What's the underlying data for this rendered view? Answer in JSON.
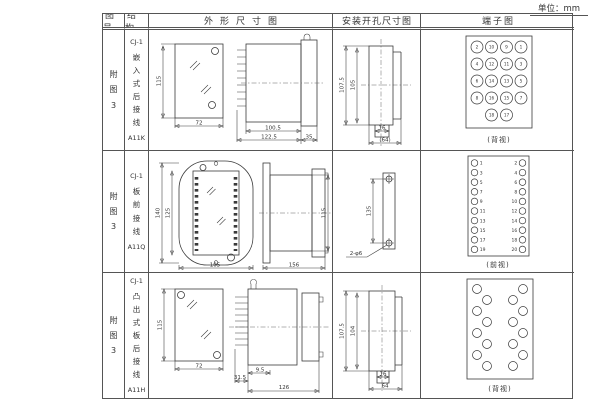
{
  "page": {
    "unit_label": "单位：mm"
  },
  "table": {
    "headers": {
      "col1": "图号",
      "col2": "结构",
      "col3": "外形尺寸图",
      "col4": "安装开孔尺寸图",
      "col5": "端子图"
    },
    "rows": [
      {
        "figure_no": "附图3",
        "structure": {
          "model": "CJ-1",
          "type": "嵌入式后接线",
          "code": "A11K"
        },
        "outline": {
          "height": "115",
          "width": "72",
          "body_len": "100.5",
          "total_len": "122.5",
          "flange": "35"
        },
        "install": {
          "outer_h": "107.5",
          "inner_h": "105",
          "slot_w": "16",
          "total_w": "(64)"
        },
        "terminal": {
          "view_label": "(背视)",
          "grid": [
            [
              "2",
              "10",
              "9",
              "1"
            ],
            [
              "4",
              "12",
              "11",
              "3"
            ],
            [
              "6",
              "14",
              "13",
              "5"
            ],
            [
              "8",
              "16",
              "15",
              "7"
            ],
            [
              "",
              "18",
              "17",
              ""
            ]
          ]
        }
      },
      {
        "figure_no": "附图3",
        "structure": {
          "model": "CJ-1",
          "type": "板前接线",
          "code": "A11Q"
        },
        "outline": {
          "height": "140",
          "inner_height": "125",
          "width": "105",
          "side_len": "156",
          "side_h": "115"
        },
        "install": {
          "hole_spacing": "135",
          "hole_callout": "2-φ6"
        },
        "terminal": {
          "view_label": "(前视)",
          "left": [
            "1",
            "3",
            "5",
            "7",
            "9",
            "11",
            "13",
            "15",
            "17",
            "19"
          ],
          "right": [
            "2",
            "4",
            "6",
            "8",
            "10",
            "12",
            "14",
            "16",
            "18",
            "20"
          ]
        }
      },
      {
        "figure_no": "附图3",
        "structure": {
          "model": "CJ-1",
          "type": "凸出式板后接线",
          "code": "A11H"
        },
        "outline": {
          "height": "115",
          "width": "72",
          "pin_len": "31.5",
          "offset": "9.5",
          "total_len": "126"
        },
        "install": {
          "outer_h": "107.5",
          "inner_h": "104",
          "slot_w": "16",
          "total_w": "64"
        },
        "terminal": {
          "view_label": "(背视)"
        }
      }
    ]
  }
}
